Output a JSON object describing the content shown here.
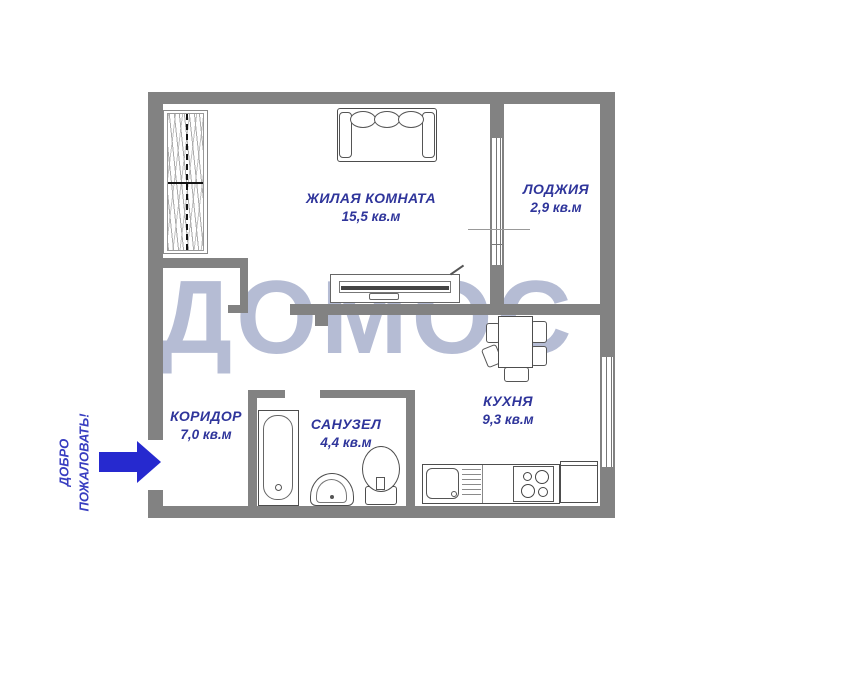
{
  "plan": {
    "watermark": "ДОМОС",
    "welcome": {
      "line1": "ДОБРО",
      "line2": "ПОЖАЛОВАТЬ!"
    },
    "rooms": {
      "living": {
        "name": "ЖИЛАЯ КОМНАТА",
        "area": "15,5 кв.м"
      },
      "loggia": {
        "name": "ЛОДЖИЯ",
        "area": "2,9 кв.м"
      },
      "corridor": {
        "name": "КОРИДОР",
        "area": "7,0 кв.м"
      },
      "bathroom": {
        "name": "САНУЗЕЛ",
        "area": "4,4 кв.м"
      },
      "kitchen": {
        "name": "КУХНЯ",
        "area": "9,3 кв.м"
      }
    },
    "furniture_icons": [
      "wardrobe",
      "sofa",
      "tv-stand",
      "dining-table",
      "chair",
      "bathtub",
      "washbasin",
      "toilet",
      "kitchen-sink",
      "stove",
      "fridge",
      "balcony-window",
      "kitchen-window",
      "entrance-arrow"
    ]
  },
  "colors": {
    "wall": "#828282",
    "line": "#4d4d4d",
    "label": "#2f359b",
    "watermark": "#a9b1cd",
    "arrow": "#2629cf",
    "welcome": "#383dc0"
  }
}
